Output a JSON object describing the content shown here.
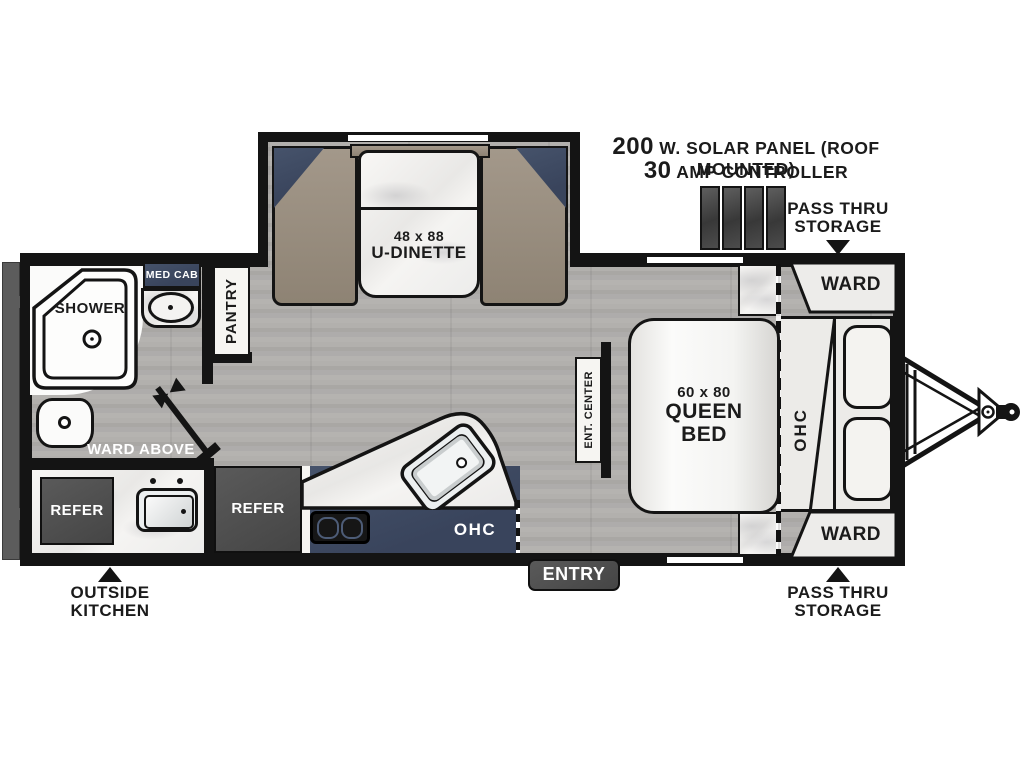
{
  "callouts": {
    "solar": {
      "value": "200",
      "text": "W. SOLAR PANEL (ROOF MOUNTED)"
    },
    "controller": {
      "value": "30",
      "text": "AMP CONTROLLER"
    },
    "pass_thru_top": {
      "line1": "PASS THRU",
      "line2": "STORAGE"
    },
    "pass_thru_bottom": {
      "line1": "PASS THRU",
      "line2": "STORAGE"
    },
    "outside_kitchen": {
      "line1": "OUTSIDE",
      "line2": "KITCHEN"
    },
    "entry": "ENTRY",
    "ward_above": "WARD ABOVE"
  },
  "rooms": {
    "dinette": {
      "size": "48 x 88",
      "name": "U-DINETTE"
    },
    "queen_bed": {
      "size": "60 x 80",
      "line1": "QUEEN",
      "line2": "BED"
    },
    "ward_top": "WARD",
    "ward_bottom": "WARD",
    "ohc_bedroom": "OHC",
    "ohc_kitchen": "OHC",
    "ent_center": "ENT. CENTER",
    "pantry": "PANTRY",
    "med_cab": "MED CAB",
    "shower": "SHOWER",
    "refer_outside": "REFER",
    "refer_main": "REFER"
  },
  "colors": {
    "wall": "#141414",
    "navy": "#3e4b61",
    "tan": "#9c9080",
    "dark_gray": "#4e4e4e",
    "floor_gray": "#aeacaa",
    "marble": "#f3f2f0"
  }
}
